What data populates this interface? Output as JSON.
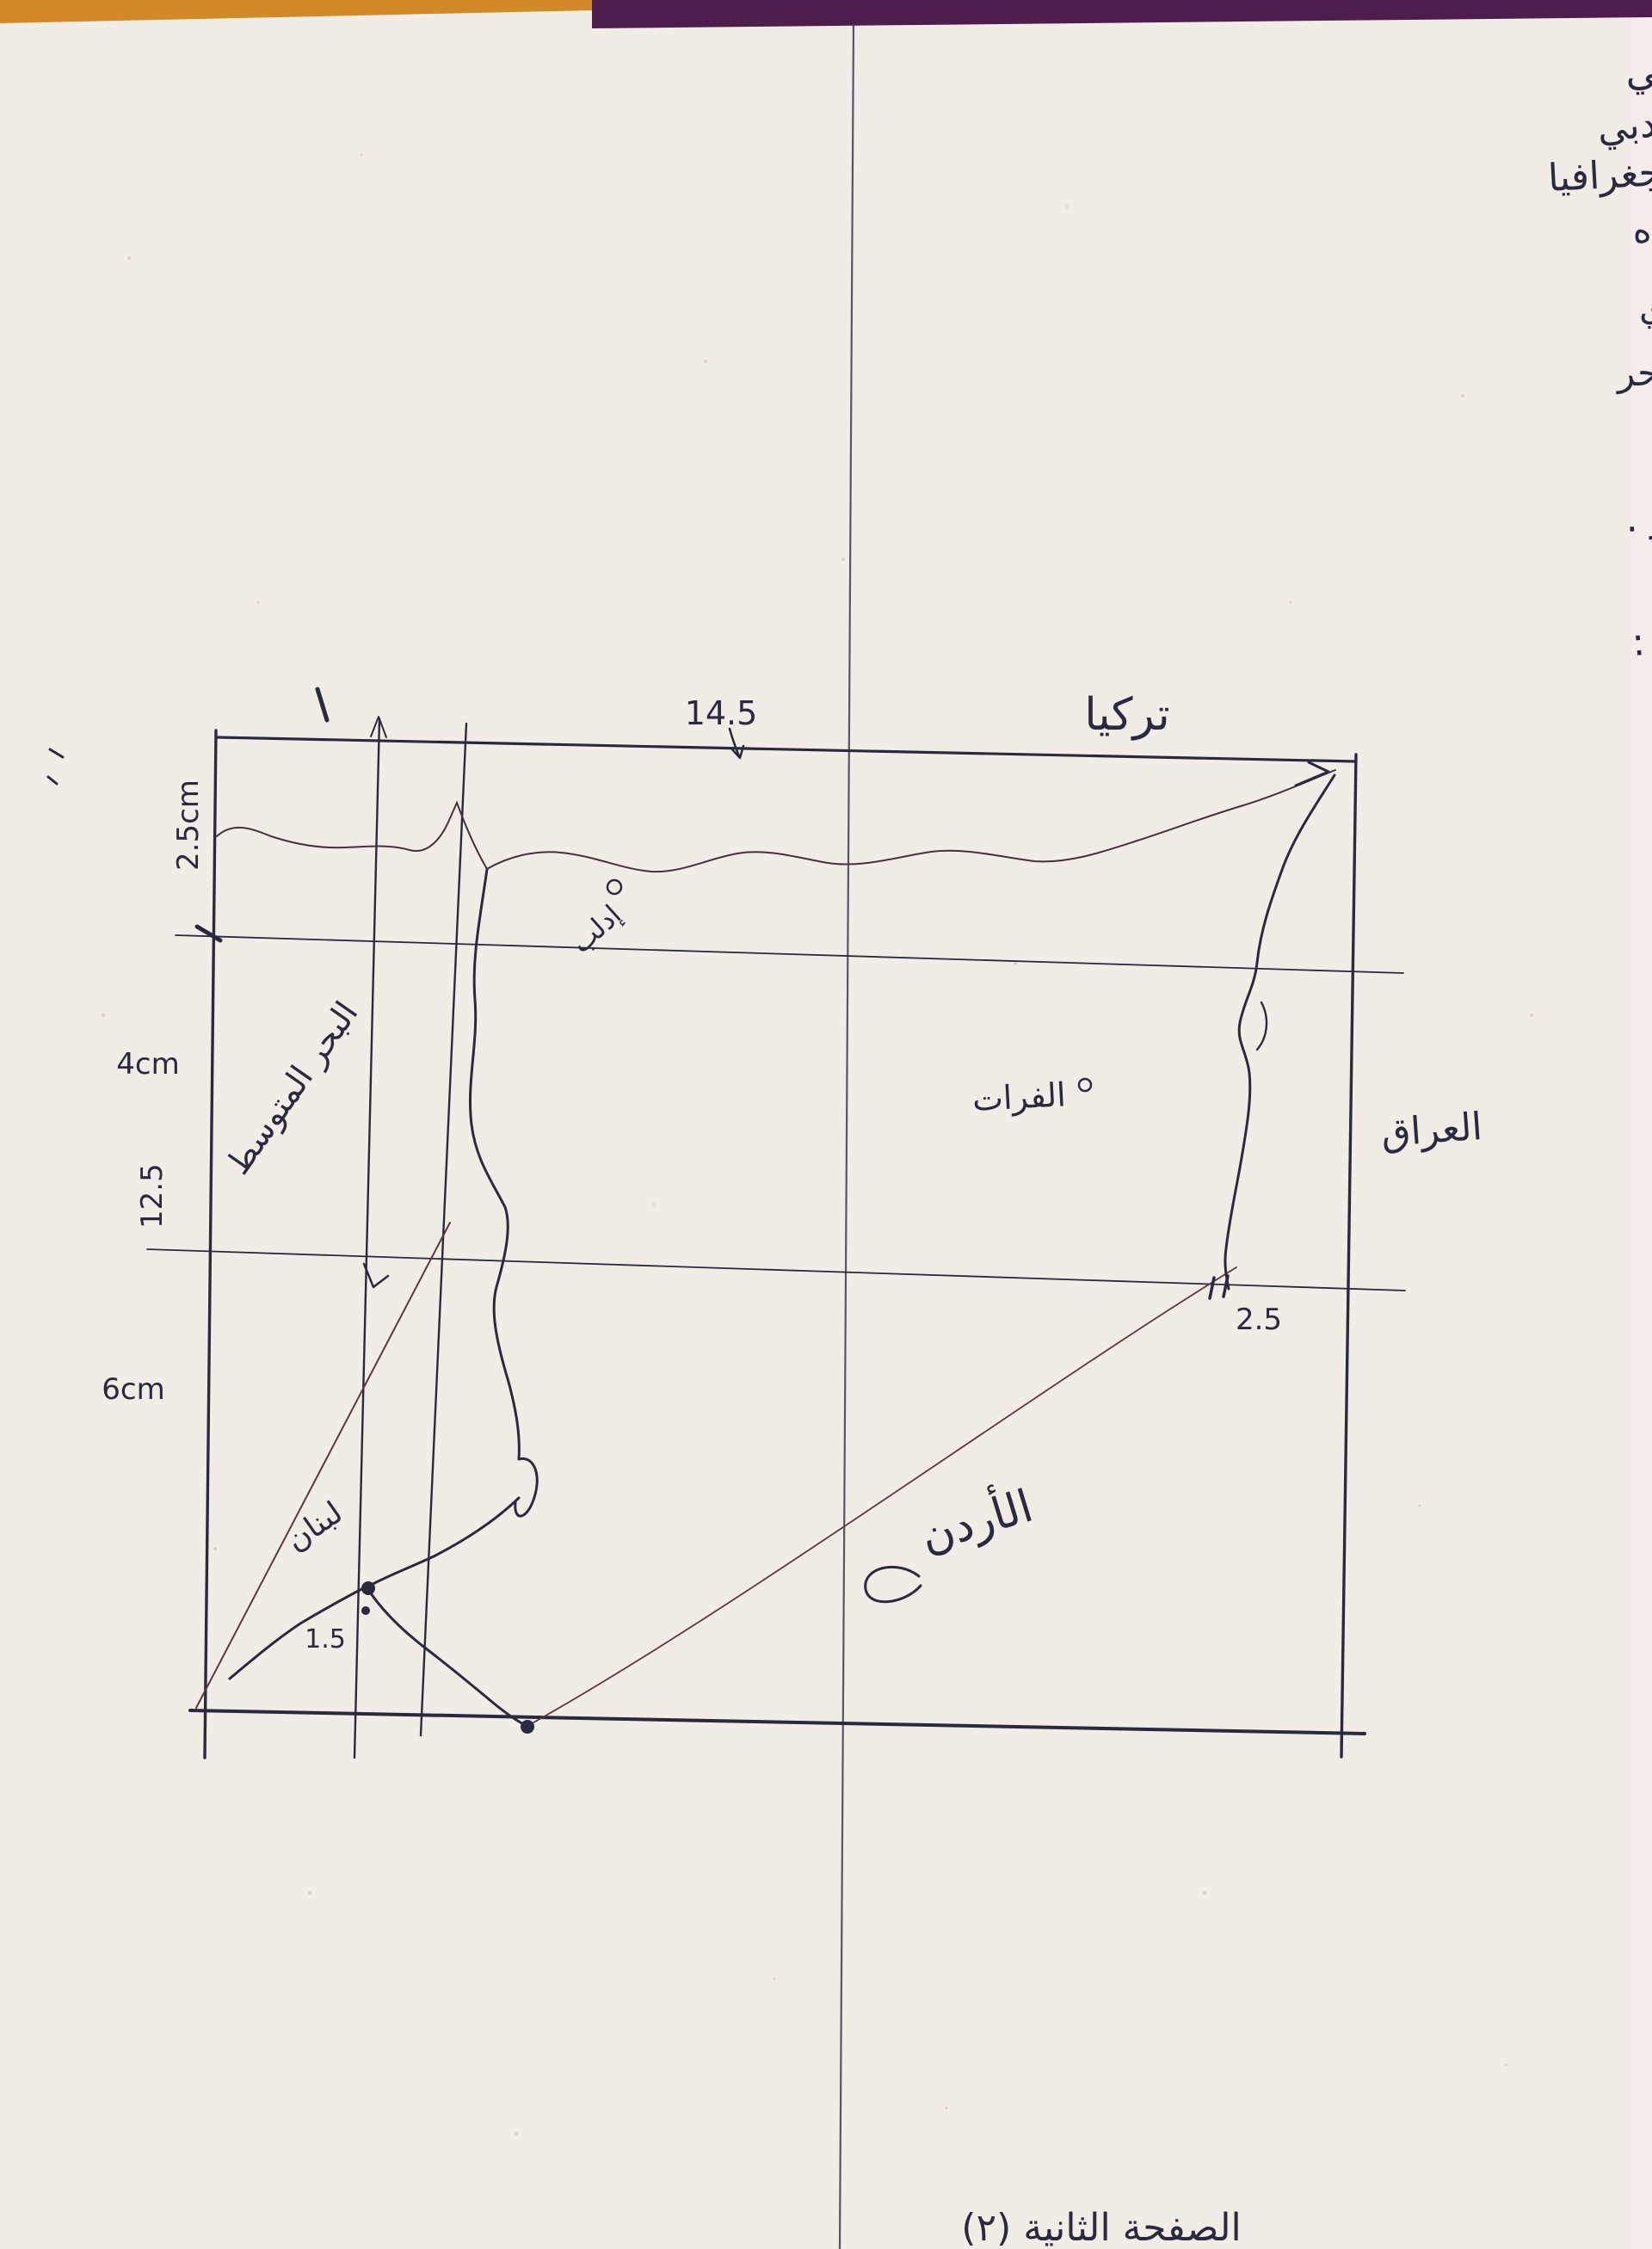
{
  "meta": {
    "description": "Scanned handwritten geography exam answer sheet with hand-drawn measured sketch map of Syria and neighbouring countries"
  },
  "header": {
    "student_name": "رند حسين الأوراخلي",
    "class_line": "ثالث ثانوي أدبي",
    "subject_line": "جغرافيا"
  },
  "answers": {
    "line1": "٦) ١) تدوير المياه ؛ وهي إعادة استخدام المياه",
    "line2": "ثم تصريفها من قبل التربة بعد استخدامها في الري",
    "item2": "٢) تحلية مياه البحر",
    "item3": "٣) حصاد مياه الأمطار .",
    "item5": "خامساً :"
  },
  "map": {
    "labels": {
      "turkey": "تركيا",
      "iraq": "العراق",
      "jordan": "الأردن",
      "lebanon": "لبنان",
      "mediterranean": "البحر المتوسط",
      "idlib": "إدلب",
      "euphrates": "الفرات"
    },
    "measurements": {
      "top_width": "14.5",
      "left_top": "2.5cm",
      "left_mid": "4cm",
      "left_mid2": "12.5",
      "left_bottom": "6cm",
      "east_segment": "2.5",
      "southwest_segment": "1.5",
      "top_tick": "١"
    }
  },
  "footer": {
    "page_label": "الصفحة الثانية (٢)"
  },
  "colors": {
    "ink": "#2b2940",
    "faint_ink": "#5d3642",
    "paper": "#f1ede6",
    "strip_orange": "#d28a28",
    "strip_purple": "#4f1d4d"
  }
}
